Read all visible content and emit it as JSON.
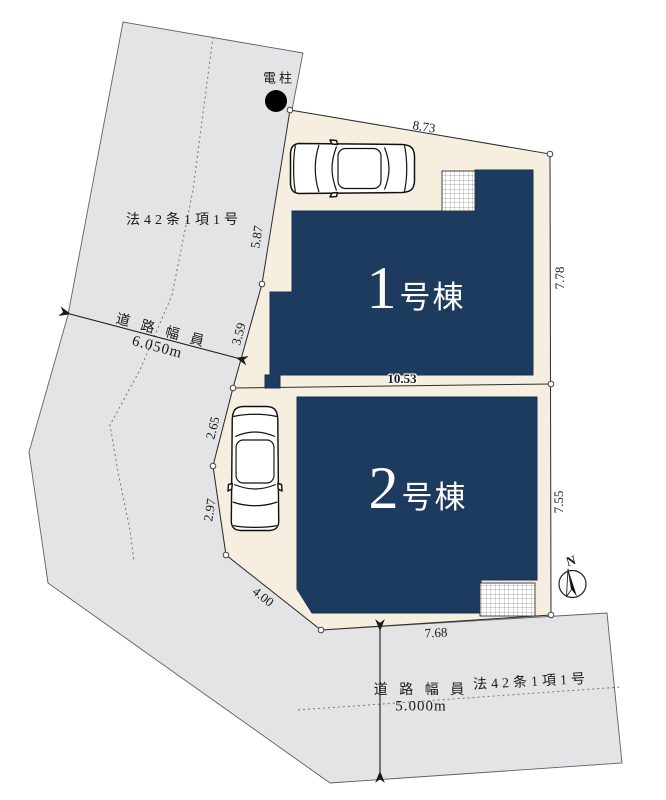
{
  "colors": {
    "building_fill": "#1d3a5f",
    "building_stroke": "#16304f",
    "building_text": "#ffffff",
    "plot_fill": "#f6efdf",
    "road_fill": "#e4e4e7",
    "line": "#2a2a2a",
    "dash": "#777777",
    "dim_text": "#1a1a1a"
  },
  "buildings": [
    {
      "number": "1",
      "suffix": "号棟"
    },
    {
      "number": "2",
      "suffix": "号棟"
    }
  ],
  "dimensions": {
    "top": "8.73",
    "left_upper": "5.87",
    "left_lower": "3.59",
    "divider": "10.53",
    "right_upper": "7.78",
    "right_lower": "7.55",
    "left2_a": "2.65",
    "left2_b": "2.97",
    "left2_c": "4.00",
    "bottom": "7.68"
  },
  "roads": {
    "left": {
      "law": "法42条1項1号",
      "width_label": "道 路 幅 員",
      "width_value": "6.050m"
    },
    "bottom": {
      "law": "法42条1項1号",
      "width_label": "道 路 幅 員",
      "width_value": "5.000m"
    }
  },
  "pole": {
    "label": "電柱"
  },
  "compass": {
    "label": "N"
  }
}
